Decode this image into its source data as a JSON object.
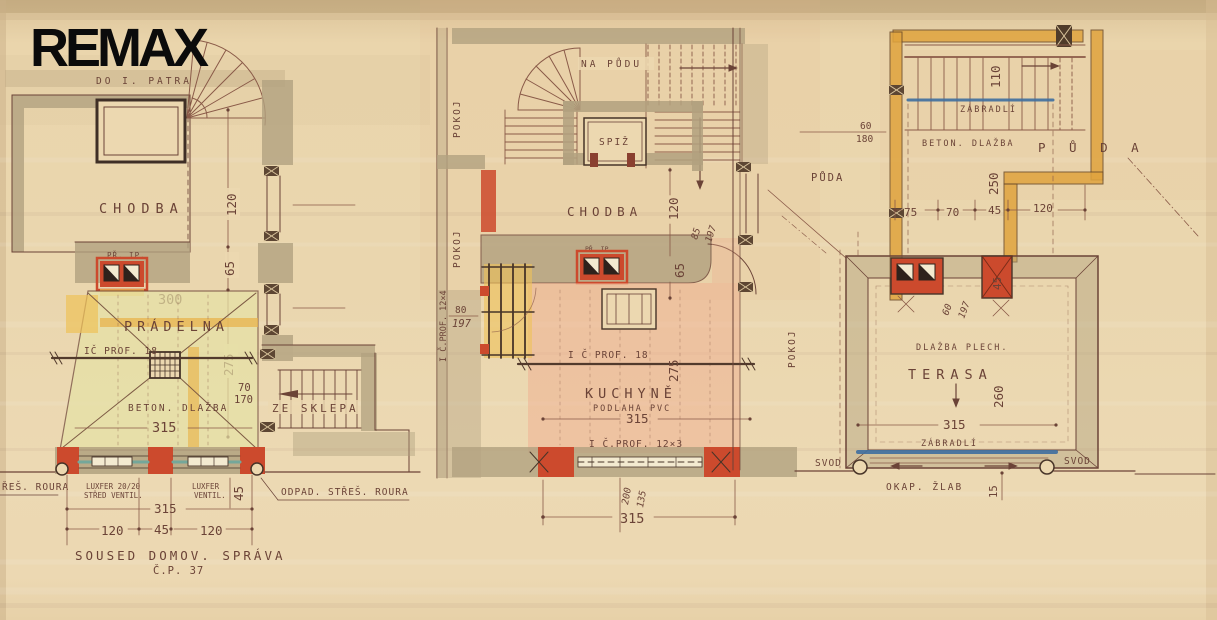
{
  "logo": "REMAX",
  "colors": {
    "paper": "#e9d4ab",
    "ink": "#6b4337",
    "wall": "#b2a17f",
    "red": "#cc4a2d",
    "orange": "#e0a43e",
    "yellow": "#eec258",
    "green_wash": "#e6e2a6",
    "pink_wash": "#efae90",
    "blue": "#3f6fa0",
    "teal": "#74a79a"
  },
  "plan_left": {
    "do_i_patra": "DO I. PATRA",
    "chodba": "CHODBA",
    "pr_ip": "PŘ. IP.",
    "dim_120": "120",
    "dim_65": "65",
    "dim_300": "300",
    "pradelna": "PRÁDELNA",
    "ic_prof_18": "IČ PROF. 18",
    "dim_275": "275",
    "dim_70": "70",
    "dim_170": "170",
    "ze_sklepa": "ZE SKLEPA",
    "beton_dlazba": "BETON. DLAŽBA",
    "dim_315": "315",
    "stres_roura": "ŘEŠ. ROURA",
    "luxfer_1a": "LUXFER 20/20",
    "luxfer_1b": "STŘED VENTIL.",
    "luxfer_2a": "LUXFER",
    "luxfer_2b": "VENTIL.",
    "dim_45_rot": "45",
    "dim_315_b": "315",
    "dim_120_a": "120",
    "dim_45": "45",
    "dim_120_b": "120",
    "soused": "SOUSED DOMOV. SPRÁVA",
    "cp_37": "Č.P. 37",
    "odpad": "ODPAD. STŘEŠ. ROURA"
  },
  "plan_middle": {
    "na_pudu": "NA PŮDU",
    "spiz": "SPIŽ",
    "pokoj_1": "POKOJ",
    "pokoj_2": "POKOJ",
    "pokoj_3": "POKOJ",
    "chodba": "CHODBA",
    "pr_ip": "PŘ. IP.",
    "dim_120": "120",
    "dim_85": "85",
    "dim_197_a": "197",
    "dim_65": "65",
    "prof_12x4": "I Č.PROF. 12×4",
    "dim_80": "80",
    "dim_197_b": "197",
    "prof_18": "I Č PROF. 18",
    "dim_275": "275",
    "kuchyne": "KUCHYNĚ",
    "podlaha_pvc": "PODLAHA PVC",
    "dim_315_a": "315",
    "prof_12x3": "I Č.PROF. 12×3",
    "dim_200": "200",
    "dim_135": "135",
    "dim_315_b": "315"
  },
  "plan_right": {
    "dim_110": "110",
    "zabradli_top": "ZÁBRADLÍ",
    "dim_60_a": "60",
    "dim_180": "180",
    "beton_dlazba": "BETON. DLAŽBA",
    "puda_spaced": "P Ů D A",
    "puda": "PŮDA",
    "dim_250": "250",
    "dim_75": "75",
    "dim_70": "70",
    "dim_45_a": "45",
    "dim_120": "120",
    "dim_45_b": "45",
    "dim_60_b": "60",
    "dim_197": "197",
    "dlazba_plech": "DLAŽBA PLECH.",
    "terasa": "TERASA",
    "dim_260": "260",
    "dim_315": "315",
    "zabradli_bottom": "ZÁBRADLÍ",
    "svod_left": "SVOD",
    "svod_right": "SVOD",
    "okap_zlab": "OKAP. ŽLAB",
    "dim_15": "15"
  }
}
